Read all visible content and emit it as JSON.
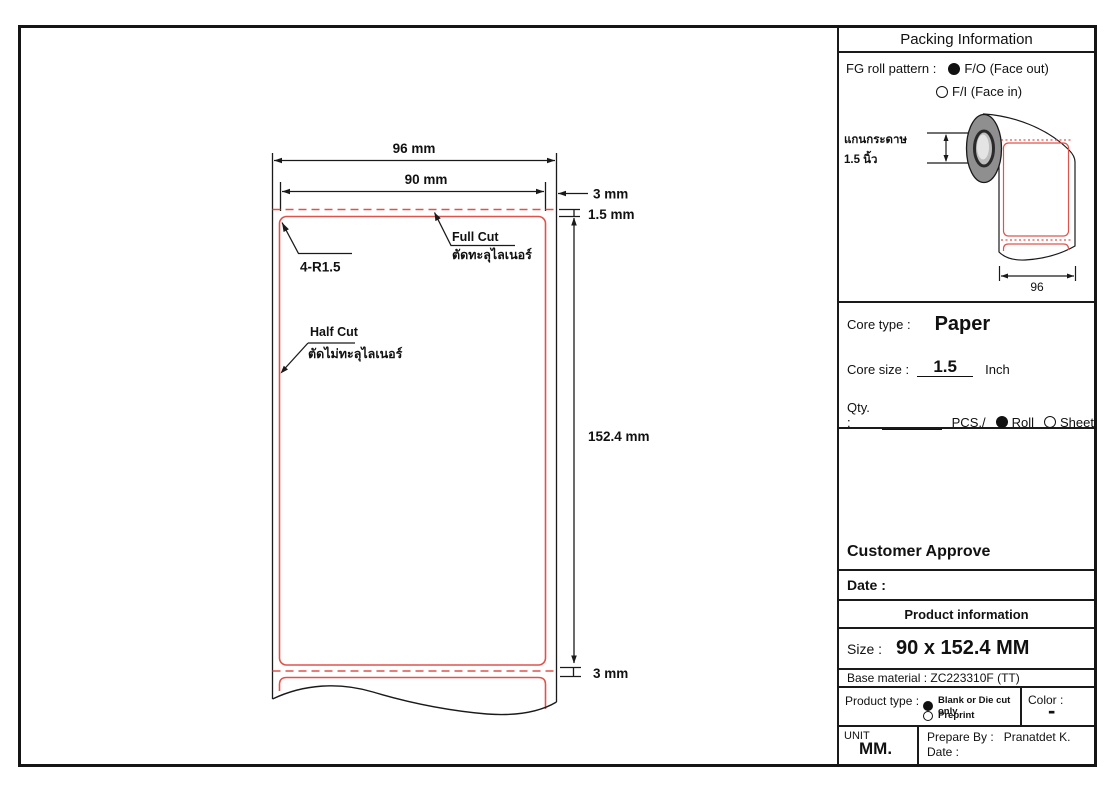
{
  "colors": {
    "cut_red": "#e0534d",
    "line_black": "#1a1a1a",
    "roll_gray": "#8f8f8f"
  },
  "drawing": {
    "dim_width_outer": "96 mm",
    "dim_width_label": "90 mm",
    "dim_margin_right": "3 mm",
    "dim_gap_top": "1.5 mm",
    "dim_height_label": "152.4 mm",
    "dim_gap_bottom": "3 mm",
    "corner_radius_note": "4-R1.5",
    "full_cut": {
      "en": "Full Cut",
      "th": "ตัดทะลุไลเนอร์"
    },
    "half_cut": {
      "en": "Half Cut",
      "th": "ตัดไม่ทะลุไลเนอร์"
    }
  },
  "panel": {
    "title": "Packing Information",
    "fg_roll_pattern": {
      "label": "FG roll pattern :",
      "options": [
        {
          "label": "F/O (Face out)",
          "selected": true
        },
        {
          "label": "F/I (Face in)",
          "selected": false
        }
      ]
    },
    "roll_diagram": {
      "core_note_line1": "แกนกระดาษ",
      "core_note_line2": "1.5 นิ้ว",
      "width_dim": "96"
    },
    "core_type": {
      "label": "Core type :",
      "value": "Paper"
    },
    "core_size": {
      "label": "Core size :",
      "value": "1.5",
      "unit": "Inch"
    },
    "qty": {
      "label": "Qty. :",
      "unit_prefix": "PCS./",
      "options": [
        {
          "label": "Roll",
          "selected": true
        },
        {
          "label": "Sheet",
          "selected": false
        }
      ]
    },
    "customer_approve_label": "Customer Approve",
    "date_label": "Date :",
    "product_information_title": "Product information",
    "size": {
      "label": "Size :",
      "value": "90 x 152.4 MM"
    },
    "base_material": "Base material : ZC223310F (TT)",
    "product_type": {
      "label": "Product type :",
      "options": [
        {
          "label": "Blank or Die cut only",
          "selected": true
        },
        {
          "label": "Preprint",
          "selected": false
        }
      ]
    },
    "color": {
      "label": "Color :",
      "value": "-"
    },
    "unit": {
      "label": "UNIT",
      "value": "MM."
    },
    "prepare": {
      "label": "Prepare By :",
      "value": "Pranatdet K.",
      "date_label": "Date :"
    }
  }
}
